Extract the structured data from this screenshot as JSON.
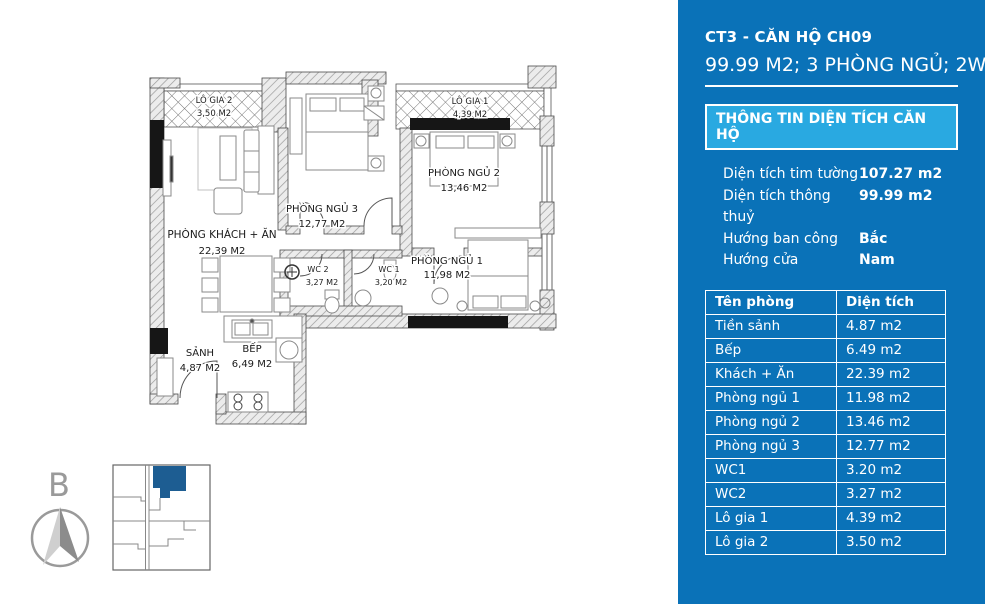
{
  "panel": {
    "title": "CT3 - CĂN HỘ CH09",
    "subtitle": "99.99 M2; 3 PHÒNG NGỦ; 2WC",
    "section_header": "THÔNG TIN DIỆN TÍCH CĂN HỘ",
    "info": [
      {
        "label": "Diện tích tim tường",
        "value": "107.27 m2"
      },
      {
        "label": "Diện tích thông thuỷ",
        "value": "99.99 m2"
      },
      {
        "label": "Hướng ban công",
        "value": "Bắc"
      },
      {
        "label": "Hướng cửa",
        "value": "Nam"
      }
    ],
    "table": {
      "headers": [
        "Tên phòng",
        "Diện tích"
      ],
      "rows": [
        [
          "Tiền sảnh",
          "4.87 m2"
        ],
        [
          "Bếp",
          "6.49 m2"
        ],
        [
          "Khách + Ăn",
          "22.39 m2"
        ],
        [
          "Phòng ngủ 1",
          "11.98 m2"
        ],
        [
          "Phòng ngủ 2",
          "13.46 m2"
        ],
        [
          "Phòng ngủ 3",
          "12.77 m2"
        ],
        [
          "WC1",
          "3.20 m2"
        ],
        [
          "WC2",
          "3.27 m2"
        ],
        [
          "Lô gia 1",
          "4.39 m2"
        ],
        [
          "Lô gia 2",
          "3.50 m2"
        ]
      ]
    },
    "colors": {
      "background": "#0a72b8",
      "section_header_bg": "#29a9e1",
      "text": "#ffffff"
    }
  },
  "plan": {
    "rooms": [
      {
        "name": "LÔ GIA 2",
        "area": "3,50 M2"
      },
      {
        "name": "PHÒNG NGỦ 3",
        "area": "12,77 M2"
      },
      {
        "name": "LÔ GIA 1",
        "area": "4,39 M2"
      },
      {
        "name": "PHÒNG NGỦ 2",
        "area": "13,46 M2"
      },
      {
        "name": "PHÒNG KHÁCH + ĂN",
        "area": "22,39 M2"
      },
      {
        "name": "WC 2",
        "area": "3,27 M2"
      },
      {
        "name": "WC 1",
        "area": "3,20 M2"
      },
      {
        "name": "PHÒNG NGỦ 1",
        "area": "11,98 M2"
      },
      {
        "name": "SẢNH",
        "area": "4,87 M2"
      },
      {
        "name": "BẾP",
        "area": "6,49 M2"
      }
    ],
    "compass_letter": "B",
    "key_plan_highlight_color": "#1d5d92"
  }
}
